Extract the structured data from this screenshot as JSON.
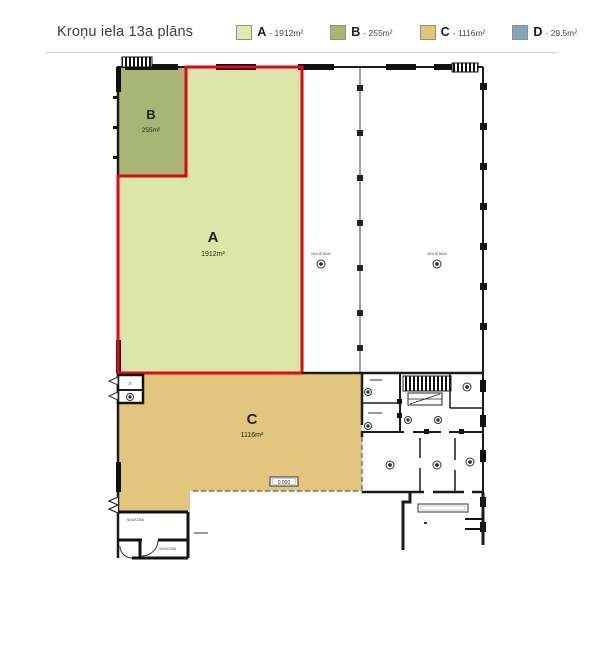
{
  "header": {
    "title": "Kroņu iela 13a plāns",
    "legend": [
      {
        "label": "A",
        "area": "- 1912m²",
        "color": "#e2e8b2"
      },
      {
        "label": "B",
        "area": "- 255m²",
        "color": "#a9b572"
      },
      {
        "label": "C",
        "area": "- 1116m²",
        "color": "#e3c577"
      },
      {
        "label": "D",
        "area": "- 29.5m²",
        "color": "#85a3b8"
      }
    ]
  },
  "plan": {
    "areas": {
      "A": {
        "letter": "A",
        "size": "1912m²",
        "fill": "#dce6ab",
        "outline": "#e30613"
      },
      "B": {
        "letter": "B",
        "size": "255m²",
        "fill": "#a8b574"
      },
      "C": {
        "letter": "C",
        "size": "1116m²",
        "fill": "#e2c67e"
      }
    },
    "labels": {
      "hall_left": "NOLIKTAVA",
      "hall_right": "NOLIKTAVA",
      "small_room": "2F",
      "room_bl_upper": "NOLIKTAVA",
      "room_bl_lower": "NOLIKTAVA",
      "elevation": "0.000"
    }
  }
}
